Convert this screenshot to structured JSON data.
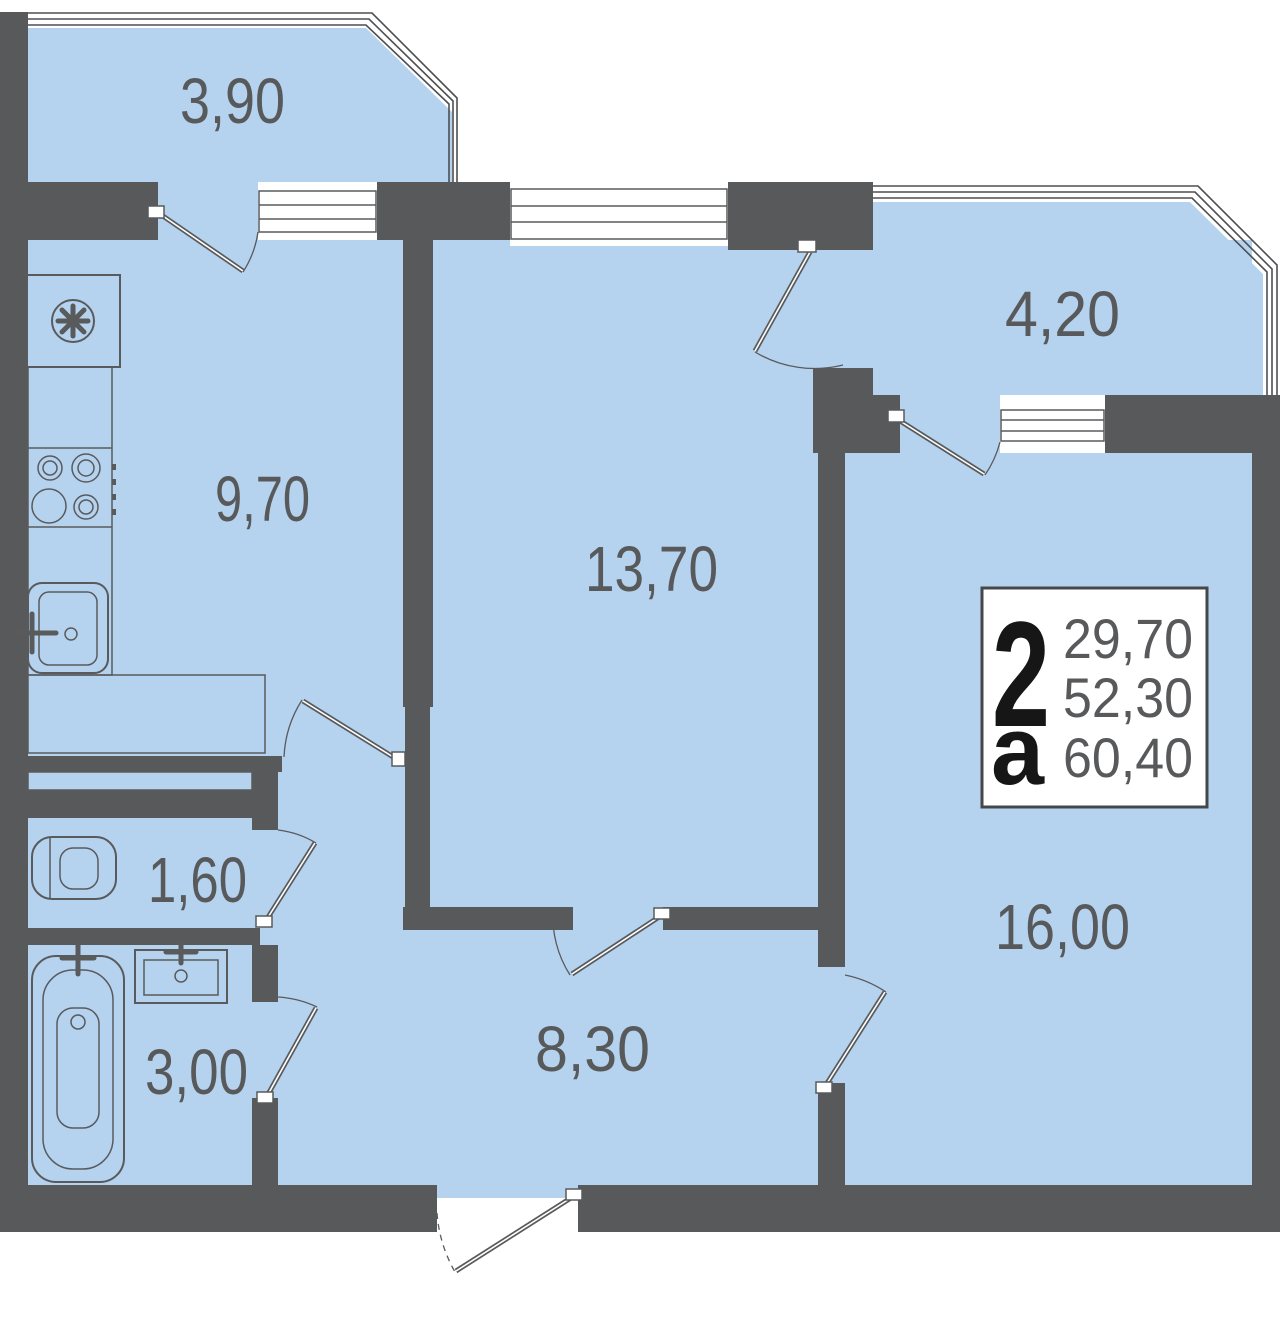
{
  "plan": {
    "badge": {
      "rooms_count": "2",
      "type_letter": "а",
      "living_area": "29,70",
      "apartment_area": "52,30",
      "total_area": "60,40"
    },
    "rooms": {
      "balcony_top_left": {
        "area": "3,90"
      },
      "kitchen": {
        "area": "9,70"
      },
      "living_room": {
        "area": "13,70"
      },
      "balcony_top_right": {
        "area": "4,20"
      },
      "bedroom": {
        "area": "16,00"
      },
      "hallway": {
        "area": "8,30"
      },
      "wc": {
        "area": "1,60"
      },
      "bathroom": {
        "area": "3,00"
      }
    },
    "colors": {
      "wall": "#58595B",
      "floor": "#B5D3EE",
      "outline": "#595A5C",
      "badge_background": "#FFFFFF",
      "badge_text_primary": "#161616",
      "badge_text_secondary": "#58595B"
    },
    "icons": {
      "fan": "fan-icon",
      "stove": "stove-icon",
      "kitchen_sink": "kitchen-sink-icon",
      "toilet": "toilet-icon",
      "bathtub": "bathtub-icon",
      "washbasin": "washbasin-icon"
    }
  }
}
